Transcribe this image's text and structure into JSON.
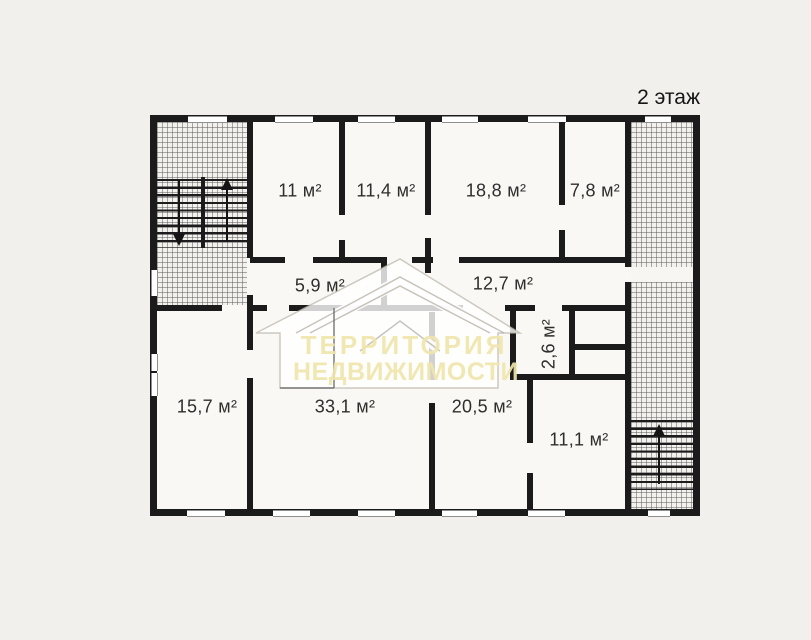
{
  "title": "2 этаж",
  "rooms": {
    "top_1": "11 м²",
    "top_2": "11,4 м²",
    "top_3": "18,8 м²",
    "top_4": "7,8 м²",
    "hall_left": "5,9 м²",
    "hall_right": "12,7 м²",
    "wc": "2,6 м²",
    "bottom_1": "15,7 м²",
    "bottom_2": "33,1 м²",
    "bottom_3": "20,5 м²",
    "bottom_4": "11,1 м²"
  },
  "watermark": {
    "line1": "ТЕРРИТОРИЯ",
    "line2": "НЕДВИЖИМОСТИ"
  },
  "icons": {
    "left_stairwell_down": "arrow-down-icon",
    "left_stairwell_up": "arrow-up-icon",
    "right_stairwell_up": "arrow-up-icon",
    "watermark_logo": "house-roofs-logo-icon"
  },
  "colors": {
    "wall": "#1b1b1b",
    "floor": "#faf8f5",
    "page_bg": "#f2f0ed",
    "watermark_text": "#f0e5ac"
  }
}
